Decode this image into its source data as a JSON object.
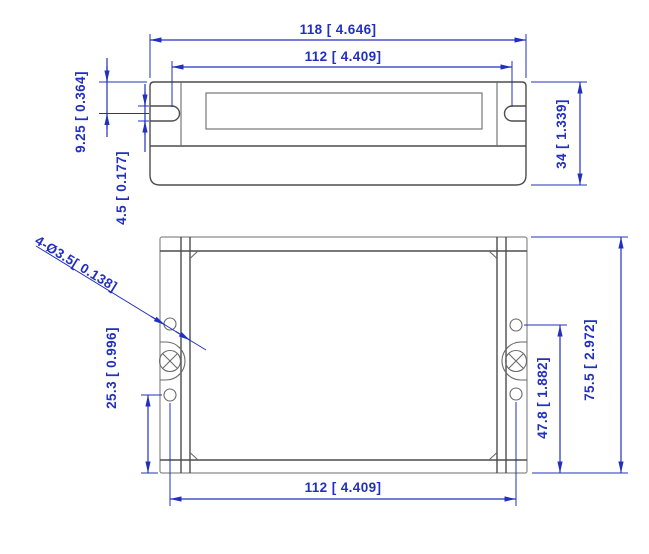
{
  "drawing_type": "mechanical-dimension-drawing",
  "colors": {
    "dimension_blue": "#2230c0",
    "outline_gray": "#4d4d4d",
    "background": "#ffffff"
  },
  "front_view": {
    "overall_width": "118 [ 4.646]",
    "mount_slot_spacing": "112 [ 4.409]",
    "slot_center_from_top": "9.25 [ 0.364]",
    "slot_width": "4.5 [ 0.177]",
    "overall_height": "34 [ 1.339]"
  },
  "top_view": {
    "hole_callout": "4-Ø3.5[ 0.138]",
    "hole_to_edge": "25.3 [ 0.996]",
    "hole_span_vertical": "47.8 [ 1.882]",
    "overall_depth": "75.5 [ 2.972]",
    "mount_hole_spacing": "112 [ 4.409]"
  }
}
